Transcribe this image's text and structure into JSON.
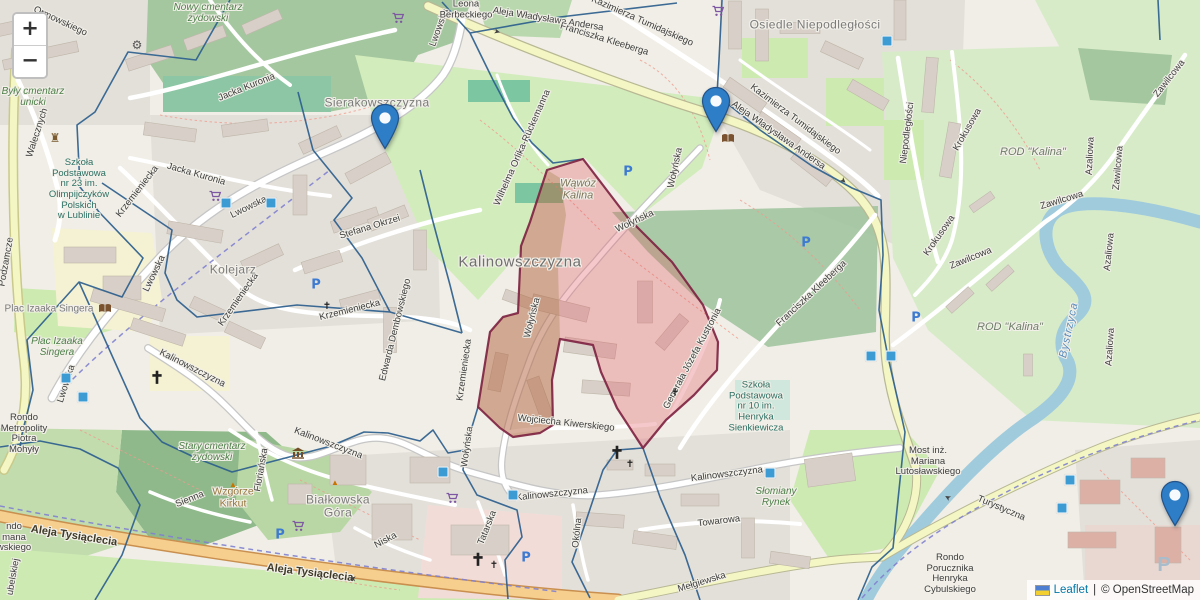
{
  "app": {
    "type": "leaflet-map-view"
  },
  "controls": {
    "zoom_in": "+",
    "zoom_out": "−"
  },
  "attribution": {
    "flag": "ukraine-flag",
    "leaflet": "Leaflet",
    "separator": "|",
    "osm": "© OpenStreetMap"
  },
  "colors": {
    "marker_blue": "#2e7ec7",
    "marker_border": "#23538a",
    "boundary_blue": "#2d5f8e",
    "highlight_fill": "#e05c64",
    "highlight_tan": "#967832",
    "highlight_border": "#7c2040",
    "water": "#a0cbdd",
    "road_primary": "#f6ce8e",
    "road_secondary": "#f4f7c3",
    "leaflet_link": "#0078a8"
  },
  "map": {
    "markers": [
      {
        "x": 385,
        "y": 150
      },
      {
        "x": 716,
        "y": 133
      },
      {
        "x": 1175,
        "y": 527
      }
    ],
    "labels": [
      {
        "t": "Nowy cmentarz\nżydowski",
        "x": 208,
        "y": 13,
        "cls": "green"
      },
      {
        "t": "Ormowskiego",
        "x": 60,
        "y": 22,
        "rot": 25,
        "cls": "street"
      },
      {
        "t": "Walecznych",
        "x": 38,
        "y": 133,
        "rot": -72,
        "cls": "street"
      },
      {
        "t": "Były cmentarz\nunicki",
        "x": 33,
        "y": 97,
        "cls": "green"
      },
      {
        "t": "Szkoła\nPodstawowa\nnr 23 im.\nOlimpijczyków\nPolskich\nw Lublinie",
        "x": 79,
        "y": 190,
        "cls": "teal"
      },
      {
        "t": "Podzamcze",
        "x": 7,
        "y": 262,
        "rot": -80,
        "cls": "street"
      },
      {
        "t": "Sierakowszczyzna",
        "x": 377,
        "y": 103,
        "cls": "place"
      },
      {
        "t": "Jacka Kuronia",
        "x": 247,
        "y": 88,
        "rot": -22,
        "cls": "street"
      },
      {
        "t": "Jacka Kuronia",
        "x": 196,
        "y": 175,
        "rot": 16,
        "cls": "street"
      },
      {
        "t": "Lwowska",
        "x": 249,
        "y": 208,
        "rot": -26,
        "cls": "street"
      },
      {
        "t": "Lwowska",
        "x": 155,
        "y": 274,
        "rot": -64,
        "cls": "street"
      },
      {
        "t": "Lwowska",
        "x": 67,
        "y": 384,
        "rot": -72,
        "cls": "street"
      },
      {
        "t": "Lwowska",
        "x": 440,
        "y": 28,
        "rot": -70,
        "cls": "street"
      },
      {
        "t": "Krzemieniecka",
        "x": 138,
        "y": 192,
        "rot": -52,
        "cls": "street"
      },
      {
        "t": "Krzemieniecka",
        "x": 239,
        "y": 300,
        "rot": -55,
        "cls": "street"
      },
      {
        "t": "Krzemieniecka",
        "x": 350,
        "y": 311,
        "rot": -14,
        "cls": "street"
      },
      {
        "t": "Krzemieniecka",
        "x": 465,
        "y": 370,
        "rot": -82,
        "cls": "street"
      },
      {
        "t": "Stefana Okrzei",
        "x": 370,
        "y": 228,
        "rot": -17,
        "cls": "street"
      },
      {
        "t": "Kolejarz",
        "x": 233,
        "y": 270,
        "cls": "place"
      },
      {
        "t": "Edwarda Dembowskiego",
        "x": 396,
        "y": 330,
        "rot": -76,
        "cls": "street"
      },
      {
        "t": "Kalinowszczyzna",
        "x": 520,
        "y": 263,
        "cls": "bigplace"
      },
      {
        "t": "Wąwóz\nKalina",
        "x": 578,
        "y": 190,
        "cls": "valley"
      },
      {
        "t": "Wołyńska",
        "x": 635,
        "y": 222,
        "rot": -25,
        "cls": "street"
      },
      {
        "t": "Wołyńska",
        "x": 533,
        "y": 318,
        "rot": -76,
        "cls": "street"
      },
      {
        "t": "Wołyńska",
        "x": 468,
        "y": 447,
        "rot": -82,
        "cls": "street"
      },
      {
        "t": "Wołyńska",
        "x": 676,
        "y": 168,
        "rot": -78,
        "cls": "street"
      },
      {
        "t": "Wilhelma Orlika-Rückemanna",
        "x": 523,
        "y": 148,
        "rot": -66,
        "cls": "street"
      },
      {
        "t": "Leona\nBerbeckiego",
        "x": 466,
        "y": 10,
        "cls": "street"
      },
      {
        "t": "Aleja Władysława Andersa",
        "x": 548,
        "y": 20,
        "rot": 9,
        "cls": "street"
      },
      {
        "t": "Aleja Władysława Andersa",
        "x": 778,
        "y": 136,
        "rot": 35,
        "cls": "street"
      },
      {
        "t": "Kazimierza Tumidajskiego",
        "x": 642,
        "y": 22,
        "rot": 24,
        "cls": "street"
      },
      {
        "t": "Kazimierza Tumidajskiego",
        "x": 795,
        "y": 120,
        "rot": 37,
        "cls": "street"
      },
      {
        "t": "Osiedle Niepodległości",
        "x": 815,
        "y": 25,
        "cls": "place"
      },
      {
        "t": "Niepodległości",
        "x": 908,
        "y": 133,
        "rot": -83,
        "cls": "street"
      },
      {
        "t": "Krokusowa",
        "x": 968,
        "y": 130,
        "rot": -60,
        "cls": "street"
      },
      {
        "t": "Krokusowa",
        "x": 940,
        "y": 236,
        "rot": -55,
        "cls": "street"
      },
      {
        "t": "Zawilcowa",
        "x": 1170,
        "y": 79,
        "rot": -52,
        "cls": "street"
      },
      {
        "t": "Zawilcowa",
        "x": 1062,
        "y": 201,
        "rot": -17,
        "cls": "street"
      },
      {
        "t": "Zawilcowa",
        "x": 971,
        "y": 259,
        "rot": -22,
        "cls": "street"
      },
      {
        "t": "Zawilcowa",
        "x": 1119,
        "y": 168,
        "rot": -85,
        "cls": "street"
      },
      {
        "t": "Azaliowa",
        "x": 1091,
        "y": 156,
        "rot": -87,
        "cls": "street"
      },
      {
        "t": "Azaliowa",
        "x": 1110,
        "y": 252,
        "rot": -84,
        "cls": "street"
      },
      {
        "t": "Azaliowa",
        "x": 1111,
        "y": 347,
        "rot": -86,
        "cls": "street"
      },
      {
        "t": "ROD \"Kalina\"",
        "x": 1033,
        "y": 152,
        "cls": "allot"
      },
      {
        "t": "ROD \"Kalina\"",
        "x": 1010,
        "y": 327,
        "cls": "allot"
      },
      {
        "t": "Bystrzyca",
        "x": 1069,
        "y": 330,
        "rot": -78,
        "cls": "water"
      },
      {
        "t": "Franciszka Kleeberga",
        "x": 812,
        "y": 294,
        "rot": -43,
        "cls": "street"
      },
      {
        "t": "Franciszka Kleeberga",
        "x": 604,
        "y": 40,
        "rot": 17,
        "cls": "street"
      },
      {
        "t": "Wojciecha Kiwerskiego",
        "x": 566,
        "y": 424,
        "rot": 6,
        "cls": "street"
      },
      {
        "t": "Generała Józefa Kustronia",
        "x": 693,
        "y": 359,
        "rot": -62,
        "cls": "street"
      },
      {
        "t": "Szkoła\nPodstawowa\nnr 10 im.\nHenryka\nSienkiewicza",
        "x": 756,
        "y": 407,
        "cls": "teal"
      },
      {
        "t": "Kalinowszczyzna",
        "x": 192,
        "y": 369,
        "rot": 27,
        "cls": "street"
      },
      {
        "t": "Kalinowszczyzna",
        "x": 328,
        "y": 444,
        "rot": 21,
        "cls": "street"
      },
      {
        "t": "Kalinowszczyzna",
        "x": 552,
        "y": 495,
        "rot": -6,
        "cls": "street"
      },
      {
        "t": "Kalinowszczyzna",
        "x": 727,
        "y": 475,
        "rot": -7,
        "cls": "street"
      },
      {
        "t": "Słomiany\nRynek",
        "x": 776,
        "y": 497,
        "cls": "green"
      },
      {
        "t": "Towarowa",
        "x": 719,
        "y": 522,
        "rot": -7,
        "cls": "street"
      },
      {
        "t": "Mełgiewska",
        "x": 702,
        "y": 583,
        "rot": -17,
        "cls": "street"
      },
      {
        "t": "Okólna",
        "x": 578,
        "y": 533,
        "rot": -84,
        "cls": "street"
      },
      {
        "t": "Tatarska",
        "x": 488,
        "y": 528,
        "rot": -68,
        "cls": "street"
      },
      {
        "t": "Niska",
        "x": 386,
        "y": 541,
        "rot": -28,
        "cls": "street"
      },
      {
        "t": "Sienna",
        "x": 190,
        "y": 500,
        "rot": -22,
        "cls": "street"
      },
      {
        "t": "Floriańska",
        "x": 262,
        "y": 470,
        "rot": -80,
        "cls": "street"
      },
      {
        "t": "Stary cmentarz\nżydowski",
        "x": 212,
        "y": 452,
        "cls": "green"
      },
      {
        "t": "Wzgórze\nKirkut",
        "x": 233,
        "y": 498,
        "cls": "brown"
      },
      {
        "t": "Białkowska\nGóra",
        "x": 338,
        "y": 507,
        "cls": "place"
      },
      {
        "t": "Aleja Tysiąclecia",
        "x": 74,
        "y": 536,
        "rot": 9,
        "cls": "roadmajor"
      },
      {
        "t": "Aleja Tysiąclecia",
        "x": 310,
        "y": 573,
        "rot": 7,
        "cls": "roadmajor"
      },
      {
        "t": "Plac Izaaka Singera",
        "x": 49,
        "y": 309,
        "cls": "place-sm"
      },
      {
        "t": "Plac Izaaka\nSingera",
        "x": 57,
        "y": 347,
        "cls": "green"
      },
      {
        "t": "Rondo\nMetropolity\nPiotra\nMohyły",
        "x": 24,
        "y": 434,
        "cls": "street"
      },
      {
        "t": "ndo\nmana\nwskiego",
        "x": 14,
        "y": 538,
        "cls": "street"
      },
      {
        "t": "ubelskiej",
        "x": 14,
        "y": 577,
        "rot": -80,
        "cls": "street"
      },
      {
        "t": "Most inż.\nMariana\nLutosławskiego",
        "x": 928,
        "y": 462,
        "cls": "street"
      },
      {
        "t": "Rondo\nPorucznika\nHenryka\nCybulskiego",
        "x": 950,
        "y": 574,
        "cls": "street"
      },
      {
        "t": "Turystyczna",
        "x": 1001,
        "y": 509,
        "rot": 23,
        "cls": "street"
      }
    ],
    "icons": [
      {
        "type": "parking",
        "x": 628,
        "y": 172
      },
      {
        "type": "parking",
        "x": 316,
        "y": 285
      },
      {
        "type": "parking",
        "x": 806,
        "y": 243
      },
      {
        "type": "parking",
        "x": 916,
        "y": 318
      },
      {
        "type": "parking",
        "x": 280,
        "y": 535
      },
      {
        "type": "parking",
        "x": 526,
        "y": 558
      },
      {
        "type": "parking_grey",
        "x": 1164,
        "y": 565
      },
      {
        "type": "stop",
        "x": 226,
        "y": 203
      },
      {
        "type": "stop",
        "x": 271,
        "y": 203
      },
      {
        "type": "stop",
        "x": 66,
        "y": 378
      },
      {
        "type": "stop",
        "x": 83,
        "y": 397
      },
      {
        "type": "stop",
        "x": 513,
        "y": 495
      },
      {
        "type": "stop",
        "x": 770,
        "y": 473
      },
      {
        "type": "stop",
        "x": 871,
        "y": 356
      },
      {
        "type": "stop",
        "x": 891,
        "y": 356
      },
      {
        "type": "stop",
        "x": 1070,
        "y": 480
      },
      {
        "type": "stop",
        "x": 1062,
        "y": 508
      },
      {
        "type": "stop",
        "x": 887,
        "y": 41
      },
      {
        "type": "stop",
        "x": 443,
        "y": 472
      },
      {
        "type": "cart",
        "x": 398,
        "y": 20
      },
      {
        "type": "cart",
        "x": 718,
        "y": 13
      },
      {
        "type": "cart",
        "x": 215,
        "y": 198
      },
      {
        "type": "cart",
        "x": 452,
        "y": 500
      },
      {
        "type": "cart",
        "x": 298,
        "y": 528
      },
      {
        "type": "church",
        "s": "b",
        "x": 157,
        "y": 378
      },
      {
        "type": "church",
        "s": "b",
        "x": 617,
        "y": 453
      },
      {
        "type": "church",
        "s": "b",
        "x": 478,
        "y": 560
      },
      {
        "type": "church",
        "x": 327,
        "y": 307
      },
      {
        "type": "church",
        "x": 675,
        "y": 394
      },
      {
        "type": "church",
        "x": 630,
        "y": 465
      },
      {
        "type": "church",
        "x": 494,
        "y": 566
      },
      {
        "type": "library",
        "x": 105,
        "y": 310
      },
      {
        "type": "library",
        "x": 728,
        "y": 140
      },
      {
        "type": "museum",
        "x": 298,
        "y": 455
      },
      {
        "type": "peak",
        "x": 233,
        "y": 485
      },
      {
        "type": "peak",
        "x": 335,
        "y": 483
      },
      {
        "type": "gear",
        "x": 137,
        "y": 45
      },
      {
        "type": "castle",
        "x": 55,
        "y": 138
      },
      {
        "type": "oneway",
        "x": 497,
        "y": 32,
        "rot": 15
      },
      {
        "type": "oneway",
        "x": 843,
        "y": 181,
        "rot": 42
      },
      {
        "type": "oneway",
        "x": 353,
        "y": 578,
        "rot": 188
      },
      {
        "type": "oneway",
        "x": 948,
        "y": 497,
        "rot": 210
      }
    ],
    "highlight_name": "selected-district-polygon"
  }
}
